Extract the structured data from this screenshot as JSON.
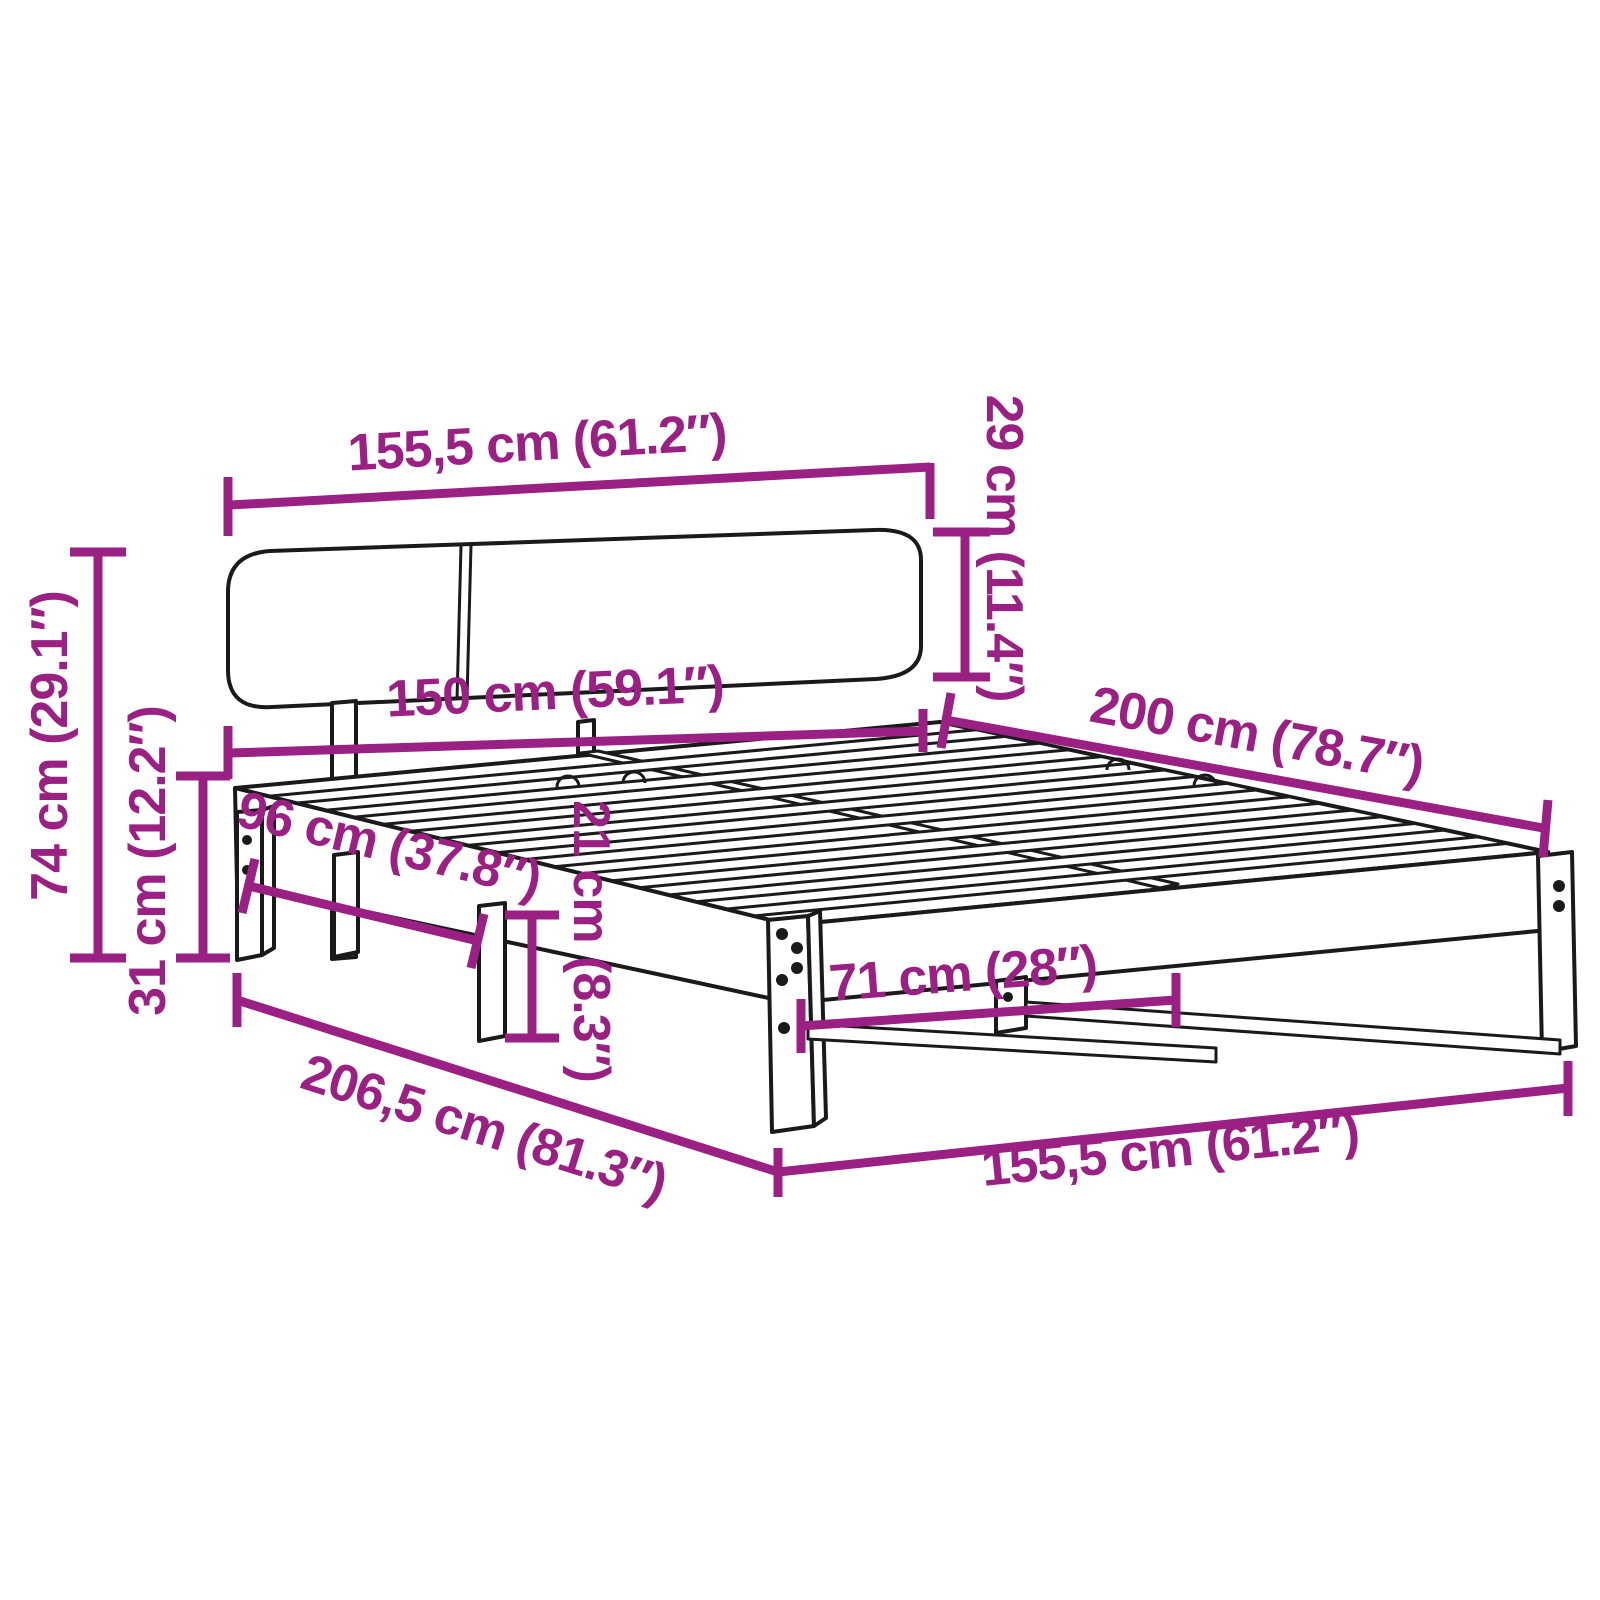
{
  "diagram": {
    "type": "product-dimension-diagram",
    "product": "bed-frame-with-headboard",
    "background": "#ffffff",
    "accent_color": "#9A2183",
    "line_color": "#1a1a1a",
    "units": [
      "cm",
      "inch"
    ]
  },
  "dims": [
    {
      "name": "headboard-width-top",
      "label": "155,5 cm (61.2″)",
      "cm": 155.5,
      "inch": 61.2
    },
    {
      "name": "headboard-panel-height",
      "label": "29 cm (11.4″)",
      "cm": 29,
      "inch": 11.4
    },
    {
      "name": "inner-width",
      "label": "150 cm (59.1″)",
      "cm": 150,
      "inch": 59.1
    },
    {
      "name": "bed-length",
      "label": "200 cm (78.7″)",
      "cm": 200,
      "inch": 78.7
    },
    {
      "name": "total-height",
      "label": "74 cm (29.1″)",
      "cm": 74,
      "inch": 29.1
    },
    {
      "name": "leg-height",
      "label": "31 cm (12.2″)",
      "cm": 31,
      "inch": 12.2
    },
    {
      "name": "side-span",
      "label": "96 cm (37.8″)",
      "cm": 96,
      "inch": 37.8
    },
    {
      "name": "frame-rail-height",
      "label": "21 cm (8.3″)",
      "cm": 21,
      "inch": 8.3
    },
    {
      "name": "leg-spacing",
      "label": "71 cm (28″)",
      "cm": 71,
      "inch": 28
    },
    {
      "name": "total-length",
      "label": "206,5 cm (81.3″)",
      "cm": 206.5,
      "inch": 81.3
    },
    {
      "name": "outer-width-bottom",
      "label": "155,5 cm (61.2″)",
      "cm": 155.5,
      "inch": 61.2
    }
  ]
}
